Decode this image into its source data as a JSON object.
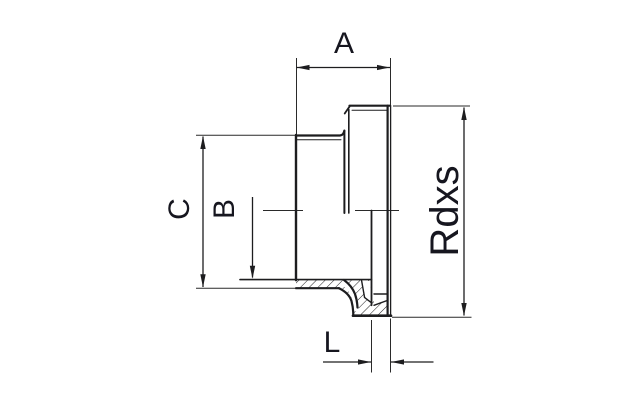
{
  "diagram": {
    "background": "#ffffff",
    "line_color": "#1d1d1f",
    "thin_line_color": "#2a2a2a",
    "label_color": "#16161f",
    "labels": {
      "overall_length": "A",
      "bore_diameter": "B",
      "body_diameter": "C",
      "thread_size": "Rdxs",
      "seat_length": "L"
    }
  }
}
